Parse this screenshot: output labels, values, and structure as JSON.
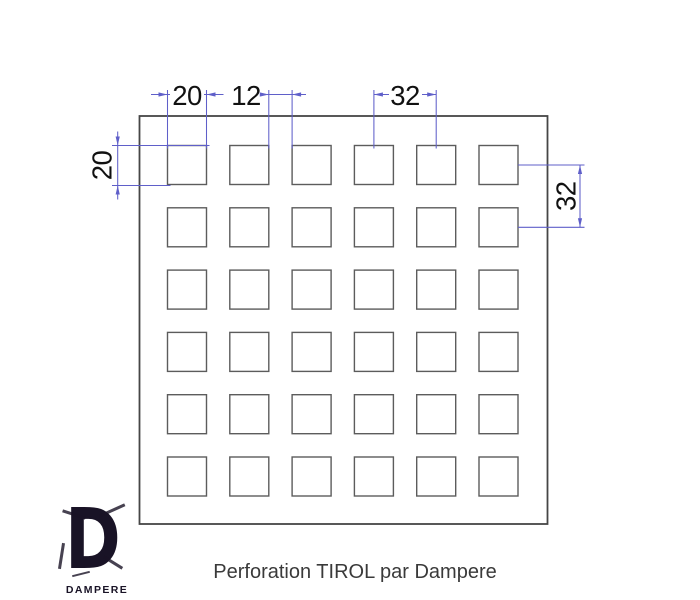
{
  "document": {
    "caption": "Perforation TIROL par Dampere"
  },
  "logo": {
    "letter": "D",
    "wordmark": "DAMPERE"
  },
  "drawing": {
    "pattern_name": "TIROL",
    "hole_shape": "square",
    "grid": {
      "rows": 6,
      "cols": 6
    },
    "dimensions": {
      "hole_width": "20",
      "gap": "12",
      "pitch_horizontal": "32",
      "hole_height": "20",
      "pitch_vertical": "32"
    },
    "colors": {
      "dimension_line": "#5f5fc9",
      "plate_outline": "#464646",
      "hole_outline": "#5c5c5c",
      "dimension_text": "#111111",
      "caption_text": "#3a3a3a"
    }
  }
}
